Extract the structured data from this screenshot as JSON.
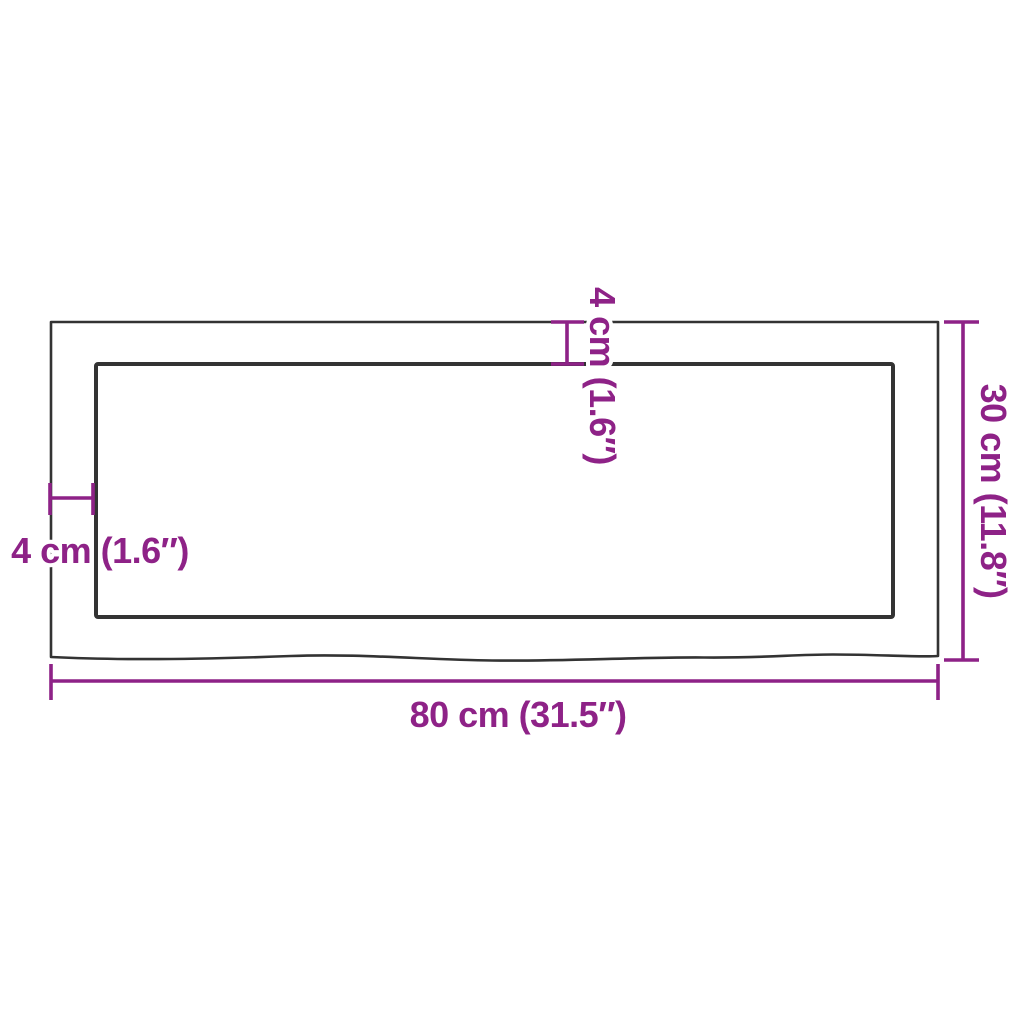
{
  "diagram": {
    "type": "product-dimension-drawing",
    "subject": "rectangular wooden table top with live (wavy) front edge, top view",
    "labels": {
      "width": "80 cm (31.5″)",
      "height": "30 cm (11.8″)",
      "edge_thickness_top": "4 cm (1.6″)",
      "edge_thickness_left": "4 cm (1.6″)"
    },
    "dimensions": {
      "width_cm": 80,
      "width_in": 31.5,
      "depth_cm": 30,
      "depth_in": 11.8,
      "edge_cm": 4,
      "edge_in": 1.6
    },
    "colors": {
      "accent": "#8E2287",
      "line": "#333333",
      "background": "#FFFFFF"
    }
  }
}
